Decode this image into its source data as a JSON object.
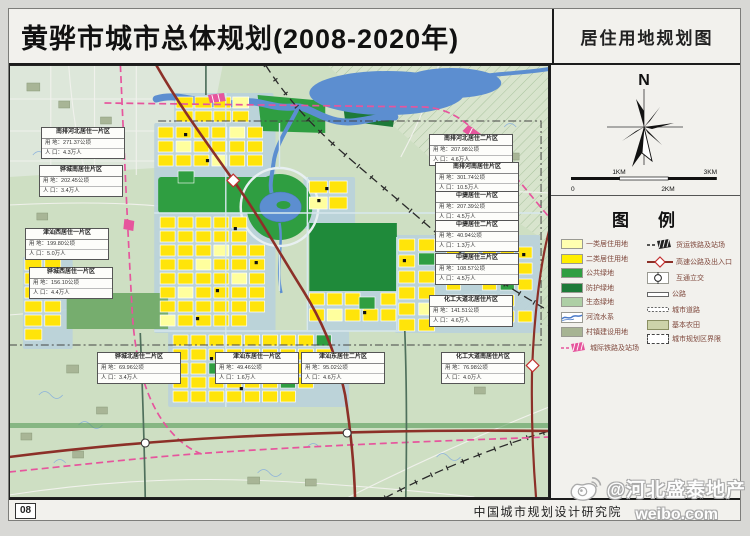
{
  "header": {
    "title": "黄骅市城市总体规划(2008-2020年)",
    "map_type_label": "居住用地规划图"
  },
  "compass": {
    "north_label": "N"
  },
  "scalebar": {
    "labels": [
      "0",
      "1KM",
      "2KM",
      "3KM"
    ]
  },
  "legend": {
    "title": "图　例",
    "left": [
      {
        "name": "class1-residential",
        "label": "一类居住用地",
        "color": "#ffffb0"
      },
      {
        "name": "class2-residential",
        "label": "二类居住用地",
        "color": "#ffee00"
      },
      {
        "name": "public-green",
        "label": "公共绿地",
        "color": "#2f9e41"
      },
      {
        "name": "protective-green",
        "label": "防护绿地",
        "color": "#1d7a38"
      },
      {
        "name": "ecological-green",
        "label": "生态绿地",
        "color": "#aecfa5"
      },
      {
        "name": "river-system",
        "label": "河流水系",
        "color": "#5c8ed0"
      },
      {
        "name": "village-construction-land",
        "label": "村镇建设用地",
        "color": "#a7b493"
      },
      {
        "name": "intercity-railway-station",
        "label": "城际铁路及站场",
        "color": "#e6559d"
      }
    ],
    "right": [
      {
        "name": "freight-railway-station",
        "label": "货运铁路及站场",
        "color": "#222222"
      },
      {
        "name": "expressway-access",
        "label": "高速公路及出入口",
        "color": "#8c3028"
      },
      {
        "name": "interchange",
        "label": "互通立交",
        "color": "#222222"
      },
      {
        "name": "highway",
        "label": "公路",
        "color": "#ffffff"
      },
      {
        "name": "city-road",
        "label": "城市道路",
        "color": "#ffffff"
      },
      {
        "name": "basic-farmland",
        "label": "基本农田",
        "color": "#cdd3a9"
      },
      {
        "name": "planning-boundary",
        "label": "城市规划区界限",
        "color": "#444444"
      }
    ]
  },
  "callouts": [
    {
      "title": "南排河北居住一片区",
      "area": "用 地：271.37公顷",
      "population": "人 口：4.3万人"
    },
    {
      "title": "骅城南居住片区",
      "area": "用 地：202.45公顷",
      "population": "人 口：3.4万人"
    },
    {
      "title": "津汕西居住一片区",
      "area": "用 地：199.80公顷",
      "population": "人 口：5.0万人"
    },
    {
      "title": "骅城西居住一片区",
      "area": "用 地：156.10公顷",
      "population": "人 口：4.4万人"
    },
    {
      "title": "南排河北居住二片区",
      "area": "用 地：207.98公顷",
      "population": "人 口：4.6万人"
    },
    {
      "title": "南排河南居住片区",
      "area": "用 地：301.74公顷",
      "population": "人 口：10.5万人"
    },
    {
      "title": "中捷居住一片区",
      "area": "用 地：207.39公顷",
      "population": "人 口：4.5万人"
    },
    {
      "title": "中捷居住二片区",
      "area": "用 地：40.94公顷",
      "population": "人 口：1.3万人"
    },
    {
      "title": "中捷居住三片区",
      "area": "用 地：108.57公顷",
      "population": "人 口：4.5万人"
    },
    {
      "title": "化工大道北居住片区",
      "area": "用 地：141.51公顷",
      "population": "人 口：4.6万人"
    },
    {
      "title": "骅城北居住二片区",
      "area": "用 地：69.96公顷",
      "population": "人 口：3.4万人"
    },
    {
      "title": "津汕东居住一片区",
      "area": "用 地：49.46公顷",
      "population": "人 口：1.6万人"
    },
    {
      "title": "津汕东居住二片区",
      "area": "用 地：95.02公顷",
      "population": "人 口：4.6万人"
    },
    {
      "title": "化工大道南居住片区",
      "area": "用 地：76.98公顷",
      "population": "人 口：4.0万人"
    }
  ],
  "footer": {
    "page_number": "08",
    "institute": "中国城市规划设计研究院"
  },
  "watermark": {
    "handle": "@河北盛泰地产",
    "site": "weibo.com"
  }
}
